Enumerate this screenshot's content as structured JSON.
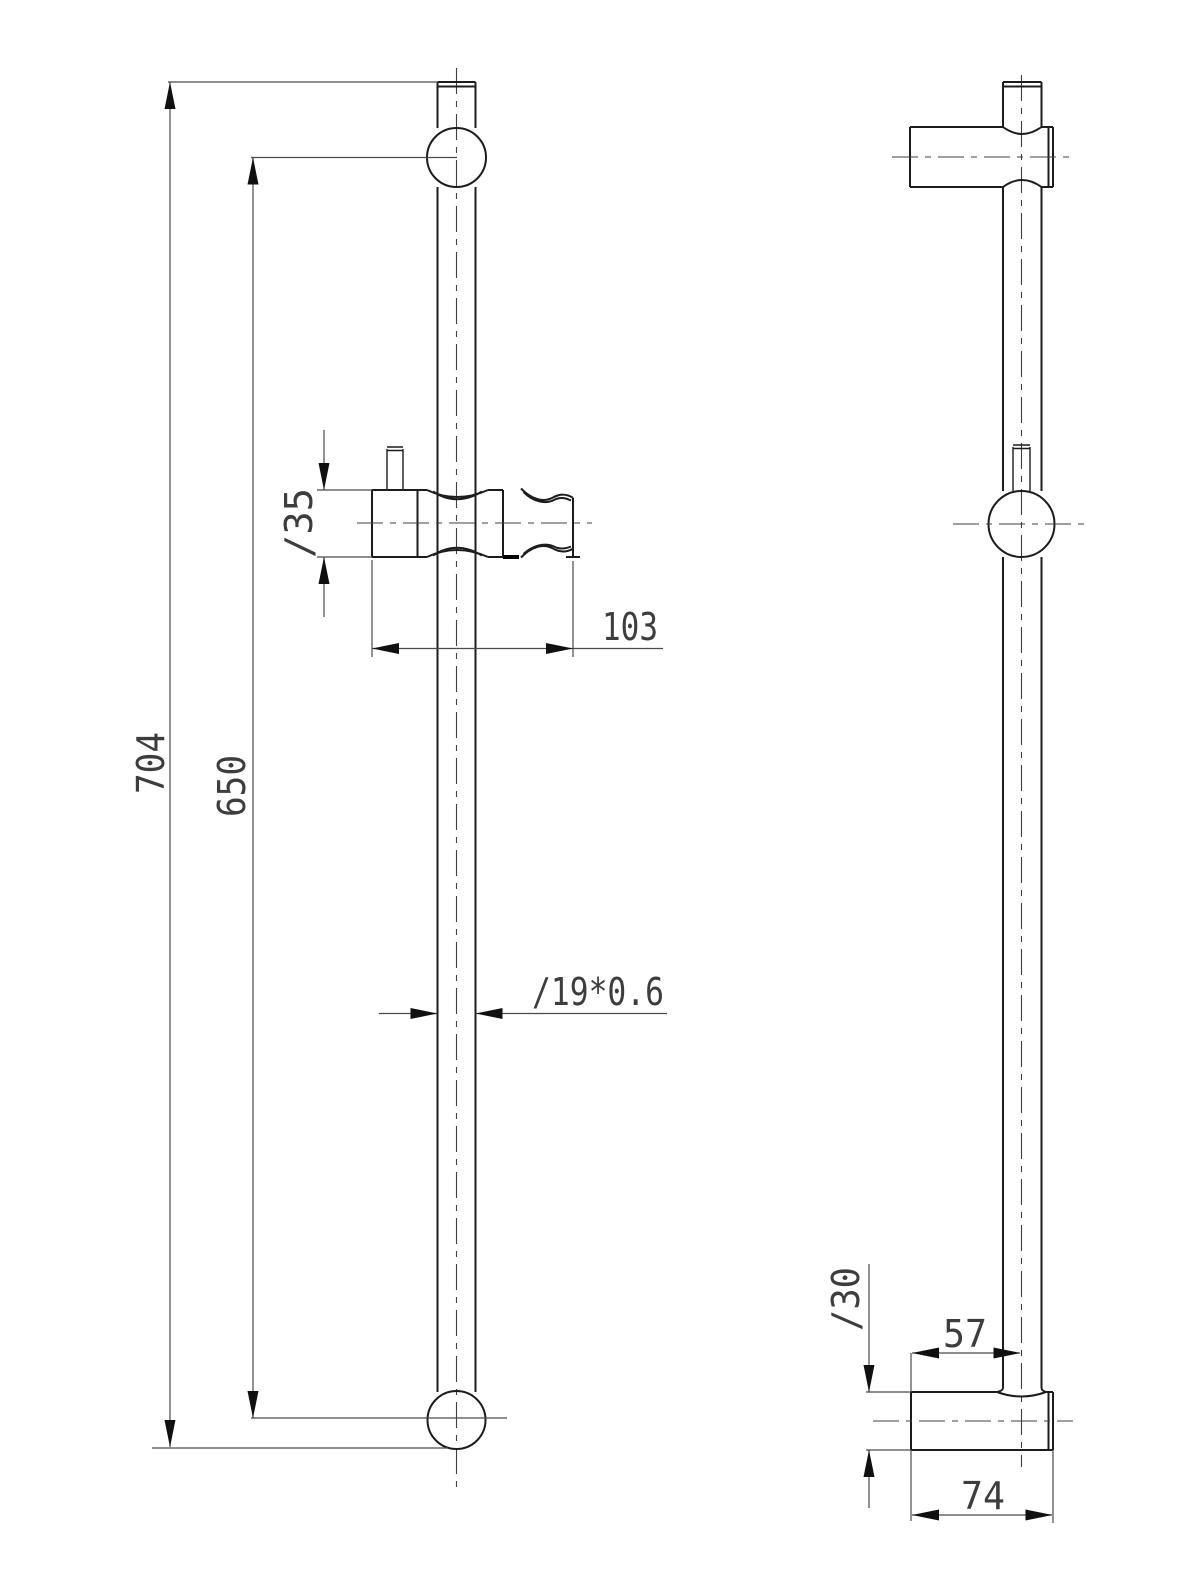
{
  "drawing": {
    "colors": {
      "background": "#ffffff",
      "object_lines": "#1c1c1c",
      "dimension_lines": "#4a4a4a"
    },
    "views": {
      "front_view": "front-view",
      "side_view": "side-view"
    },
    "dimensions": {
      "overall_length": "704",
      "rail_span": "650",
      "holder_diameter": "∕35",
      "holder_width": "103",
      "tube_spec": "∕19*0.6",
      "bracket_diameter": "∕30",
      "wall_to_center": "57",
      "bracket_depth": "74"
    }
  }
}
